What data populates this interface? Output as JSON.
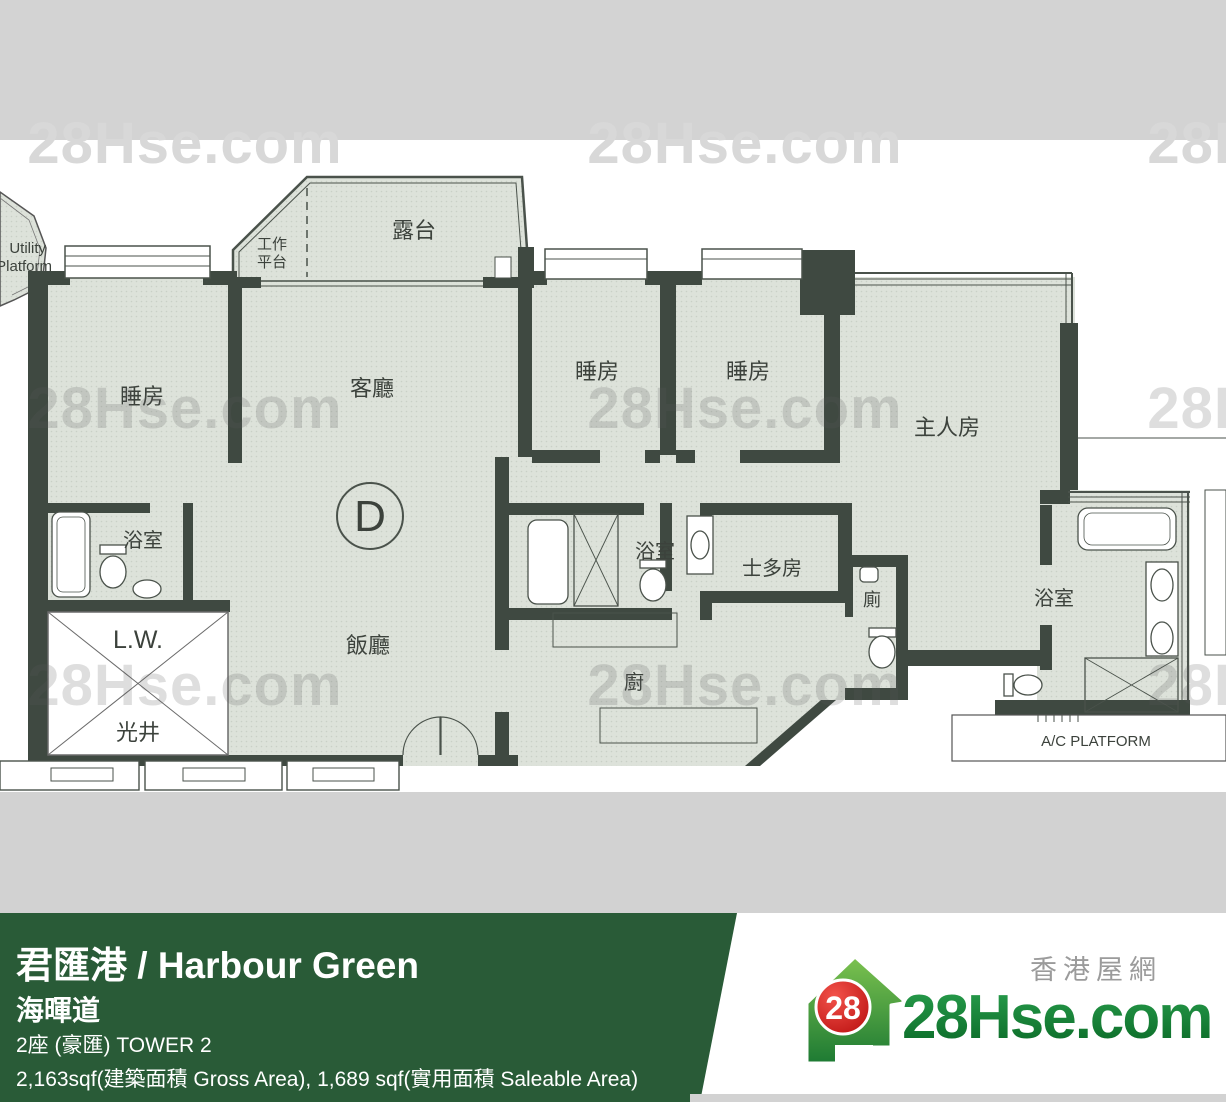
{
  "watermark": {
    "text": "28Hse.com"
  },
  "floorplan": {
    "labels": {
      "balcony": "露台",
      "work_platform_line1": "工作",
      "work_platform_line2": "平台",
      "utility_line1": "Utility",
      "utility_line2": "Platform",
      "bedroom": "睡房",
      "living": "客廳",
      "dining": "飯廳",
      "master": "主人房",
      "bath": "浴室",
      "store": "士多房",
      "toilet": "廁",
      "kitchen": "廚",
      "lw": "L.W.",
      "lightwell": "光井",
      "unit": "D",
      "ac_platform": "A/C PLATFORM"
    }
  },
  "footer": {
    "title": "君匯港 / Harbour Green",
    "street": "海暉道",
    "tower": "2座 (豪匯)   TOWER 2",
    "area": "2,163sqf(建築面積 Gross Area), 1,689 sqf(實用面積 Saleable Area)",
    "colors": {
      "bar_green": "#295b37",
      "logo_green": "#17833d",
      "badge_red": "#cc1f1f",
      "band_gray": "#d3d3d3"
    }
  },
  "brand": {
    "site_name_cn": "香港屋網",
    "logo_text": "28Hse.com",
    "badge": "28"
  }
}
